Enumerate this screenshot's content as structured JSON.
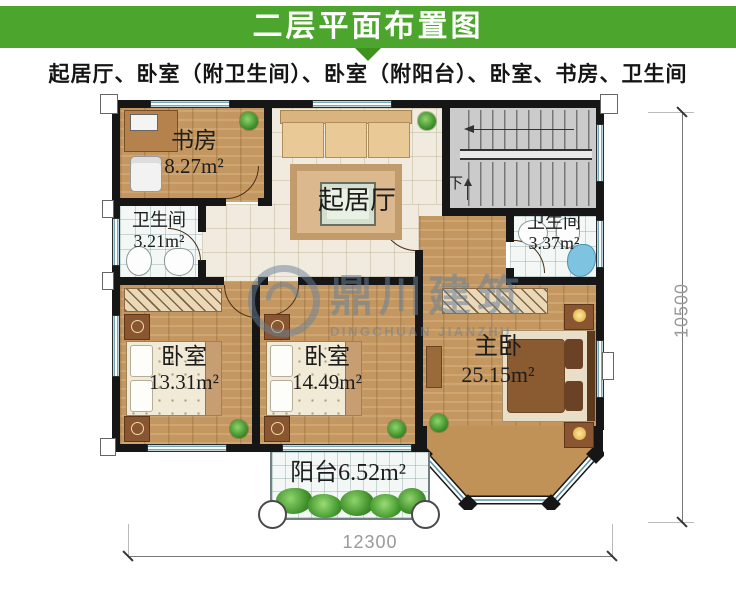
{
  "header": {
    "title": "二层平面布置图"
  },
  "subtitle": "起居厅、卧室（附卫生间）、卧室（附阳台）、卧室、书房、卫生间",
  "rooms": {
    "study": {
      "name": "书房",
      "area": "8.27m²"
    },
    "living": {
      "name": "起居厅"
    },
    "bath_left": {
      "name": "卫生间",
      "area": "3.21m²"
    },
    "bath_right": {
      "name": "卫生间",
      "area": "3.37m²"
    },
    "bedroom_left": {
      "name": "卧室",
      "area": "13.31m²"
    },
    "bedroom_mid": {
      "name": "卧室",
      "area": "14.49m²"
    },
    "master": {
      "name": "主卧",
      "area": "25.15m²"
    },
    "balcony": {
      "name": "阳台",
      "area": "6.52m²"
    }
  },
  "stairs": {
    "down_label": "下"
  },
  "dimensions": {
    "width_mm": "12300",
    "height_mm": "10500"
  },
  "watermark": {
    "cn": "鼎川建筑",
    "en": "DINGCHUAN JIANZHU"
  },
  "colors": {
    "banner_green": "#4ca62d",
    "banner_arrow_green": "#3f9120",
    "wall_black": "#161616",
    "wood_floor": "#c49760",
    "hall_tile": "#f0ebde",
    "bath_tile": "#f3f7f6",
    "stair_gray": "#cbcbcb",
    "window_blue": "#74a7ba",
    "watermark_blue": "rgba(104,128,152,0.55)"
  }
}
